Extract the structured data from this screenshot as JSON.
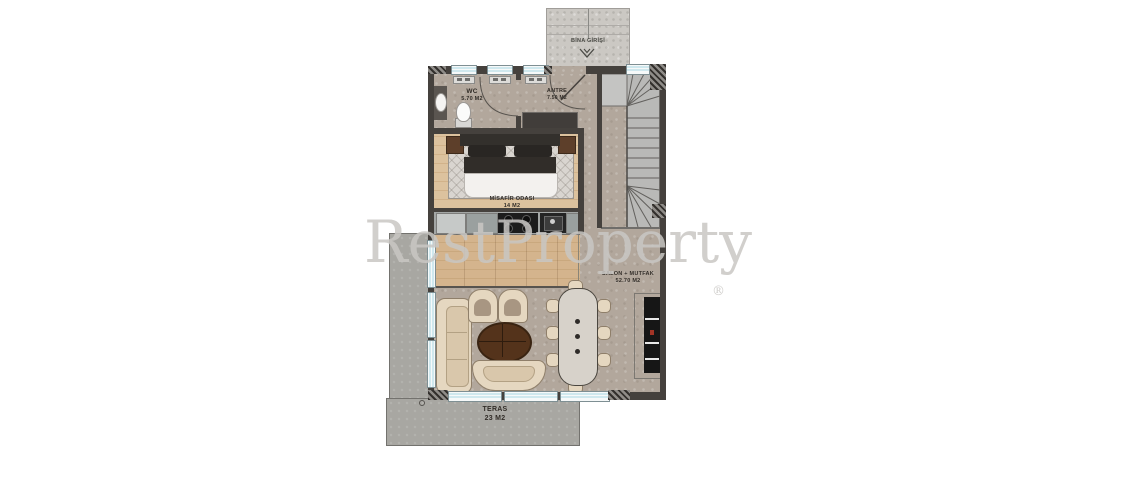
{
  "watermark": {
    "text": "RestProperty",
    "registered": "®"
  },
  "entrance": {
    "label": "BİNA GİRİŞİ"
  },
  "rooms": {
    "wc": {
      "name": "WC",
      "area": "5.70 M2"
    },
    "antre": {
      "name": "ANTRE",
      "area": "7.50 M2"
    },
    "misafir": {
      "name": "MİSAFİR ODASI",
      "area": "14 M2"
    },
    "salon": {
      "name": "SALON + MUTFAK",
      "area": "52.70 M2"
    },
    "teras": {
      "name": "TERAS",
      "area": "23 M2"
    }
  },
  "icons": {
    "entrance_direction": "double-chevron-down"
  },
  "colors": {
    "floor_stone": "#b2a79c",
    "floor_wood": "#d2b28b",
    "wall": "#45413d",
    "window_glass": "#cfe8ee",
    "terrace": "#a8a7a2",
    "entrance_platform": "#cbc8c3",
    "stairs": "#b9b9b7",
    "furniture_cream": "#e5d7c0",
    "coffee_table": "#54331b",
    "bed_dark": "#2c2926",
    "tv_unit": "#161616"
  }
}
